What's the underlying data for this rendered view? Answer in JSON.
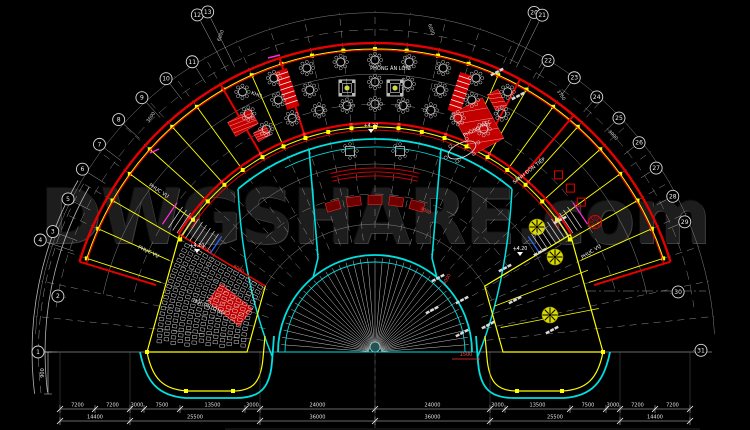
{
  "watermark": {
    "text": "DWGSHARE.com"
  },
  "colors": {
    "background": "#000000",
    "wall_red": "#e60000",
    "dark_red": "#6e0000",
    "grid_yellow": "#ffff00",
    "corridor_cyan": "#00e0e0",
    "line_gray": "#9b9b9b",
    "dim_white": "#e0e0e0",
    "accent_magenta": "#ff2bd6",
    "accent_blue": "#2b6bff",
    "level_green": "#cddc39",
    "watermark_gray": "#1d1d1d"
  },
  "grid": {
    "bubbles": [
      {
        "n": "1",
        "a": 180,
        "r": 337
      },
      {
        "n": "2",
        "a": 170,
        "r": 322
      },
      {
        "n": "3",
        "a": 159.5,
        "r": 344
      },
      {
        "n": "4",
        "a": 161.5,
        "r": 353
      },
      {
        "n": "5",
        "a": 153.5,
        "r": 343
      },
      {
        "n": "6",
        "a": 148,
        "r": 345
      },
      {
        "n": "7",
        "a": 143,
        "r": 345
      },
      {
        "n": "8",
        "a": 137.8,
        "r": 346
      },
      {
        "n": "9",
        "a": 132.5,
        "r": 345
      },
      {
        "n": "10",
        "a": 127.4,
        "r": 344
      },
      {
        "n": "11",
        "a": 122.2,
        "r": 343
      },
      {
        "n": "12",
        "a": 117.8,
        "r": 381
      },
      {
        "n": "13",
        "a": 116.2,
        "r": 379
      },
      {
        "n": "20",
        "a": 64.9,
        "r": 375
      },
      {
        "n": "21",
        "a": 63.6,
        "r": 376
      },
      {
        "n": "22",
        "a": 59.3,
        "r": 339
      },
      {
        "n": "23",
        "a": 54,
        "r": 339
      },
      {
        "n": "24",
        "a": 49,
        "r": 338
      },
      {
        "n": "25",
        "a": 43.8,
        "r": 338
      },
      {
        "n": "26",
        "a": 38.4,
        "r": 337
      },
      {
        "n": "27",
        "a": 33.2,
        "r": 336
      },
      {
        "n": "28",
        "a": 27.6,
        "r": 336
      },
      {
        "n": "29",
        "a": 22.8,
        "r": 336
      },
      {
        "n": "30",
        "a": 11.2,
        "r": 309
      },
      {
        "n": "31",
        "a": 0.3,
        "r": 326
      }
    ]
  },
  "rooms": [
    {
      "label": "PHÒNG ĂN LỚN",
      "x": 390,
      "y": 70,
      "rot": 0
    },
    {
      "label": "PHÒNG TIỆC",
      "x": 478,
      "y": 130,
      "rot": -28
    },
    {
      "label": "KHO",
      "x": 256,
      "y": 96,
      "rot": 20
    },
    {
      "label": "PHỤC VỤ",
      "x": 158,
      "y": 192,
      "rot": 33
    },
    {
      "label": "PHỤC VỤ",
      "x": 148,
      "y": 253,
      "rot": 25
    },
    {
      "label": "SẢNH ĐÓN TIẾP",
      "x": 530,
      "y": 172,
      "rot": -38
    },
    {
      "label": "PHỤC VỤ",
      "x": 592,
      "y": 253,
      "rot": -33
    },
    {
      "label": "HỘI TRƯỜNG",
      "x": 208,
      "y": 308,
      "rot": 23
    }
  ],
  "levels": [
    {
      "text": "+4.20",
      "x": 371,
      "y": 127
    },
    {
      "text": "+4.20",
      "x": 197,
      "y": 247
    },
    {
      "text": "+4.20",
      "x": 520,
      "y": 250
    }
  ],
  "dims": {
    "row1": [
      {
        "label": "7200",
        "x1": 60,
        "x2": 95
      },
      {
        "label": "7200",
        "x1": 95,
        "x2": 130
      },
      {
        "label": "3000",
        "x1": 130,
        "x2": 144
      },
      {
        "label": "7500",
        "x1": 144,
        "x2": 180
      },
      {
        "label": "13500",
        "x1": 180,
        "x2": 245
      },
      {
        "label": "3000",
        "x1": 245,
        "x2": 260
      },
      {
        "label": "24000",
        "x1": 260,
        "x2": 375
      },
      {
        "label": "24000",
        "x1": 375,
        "x2": 490
      },
      {
        "label": "3000",
        "x1": 490,
        "x2": 505
      },
      {
        "label": "13500",
        "x1": 505,
        "x2": 570
      },
      {
        "label": "7500",
        "x1": 570,
        "x2": 606
      },
      {
        "label": "3000",
        "x1": 606,
        "x2": 620
      },
      {
        "label": "7200",
        "x1": 620,
        "x2": 655
      },
      {
        "label": "7200",
        "x1": 655,
        "x2": 690
      }
    ],
    "row2": [
      {
        "label": "14400",
        "x1": 60,
        "x2": 130
      },
      {
        "label": "25500",
        "x1": 130,
        "x2": 260
      },
      {
        "label": "36000",
        "x1": 260,
        "x2": 375
      },
      {
        "label": "36000",
        "x1": 375,
        "x2": 490
      },
      {
        "label": "25500",
        "x1": 490,
        "x2": 620
      },
      {
        "label": "14400",
        "x1": 620,
        "x2": 690
      }
    ],
    "vertical": {
      "label": "900",
      "x": 48,
      "y1": 352,
      "y2": 394
    },
    "red": {
      "label": "1500",
      "x": 466,
      "y": 356
    },
    "rotated_white": [
      {
        "label": "6000",
        "x": 222,
        "y": 36,
        "rot": -70
      },
      {
        "label": "3600",
        "x": 152,
        "y": 118,
        "rot": -55
      },
      {
        "label": "6000",
        "x": 430,
        "y": 30,
        "rot": 70
      },
      {
        "label": "3750",
        "x": 560,
        "y": 96,
        "rot": 55
      },
      {
        "label": "3000",
        "x": 612,
        "y": 136,
        "rot": 46
      }
    ],
    "rotated_red": [
      {
        "label": "6000",
        "x": 205,
        "y": 250,
        "rot": 31
      },
      {
        "label": "6000",
        "x": 238,
        "y": 270,
        "rot": 31
      },
      {
        "label": "3000",
        "x": 448,
        "y": 280,
        "rot": -60
      },
      {
        "label": "3000",
        "x": 425,
        "y": 212,
        "rot": 25
      }
    ]
  }
}
